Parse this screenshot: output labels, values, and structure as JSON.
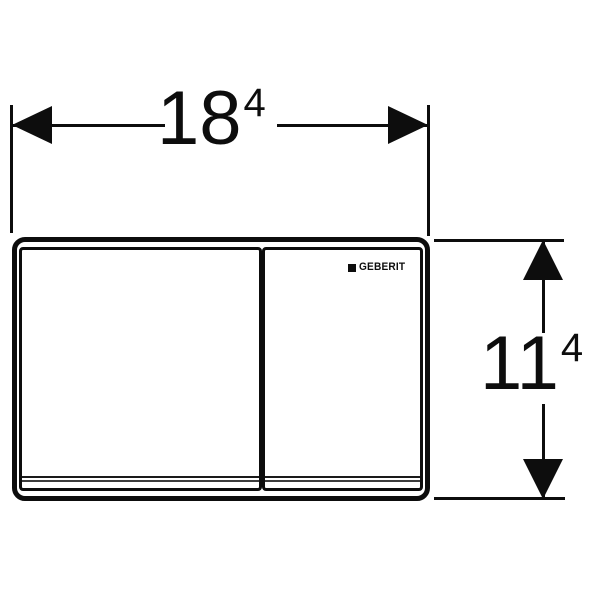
{
  "diagram": {
    "colors": {
      "line": "#0d0d0d",
      "background": "#ffffff"
    },
    "brand": {
      "logo_text": "GEBERIT",
      "logo_mark": "black-square"
    },
    "dimensions": {
      "width": {
        "main": "18",
        "sup": "4"
      },
      "height": {
        "main": "11",
        "sup": "4"
      }
    }
  }
}
